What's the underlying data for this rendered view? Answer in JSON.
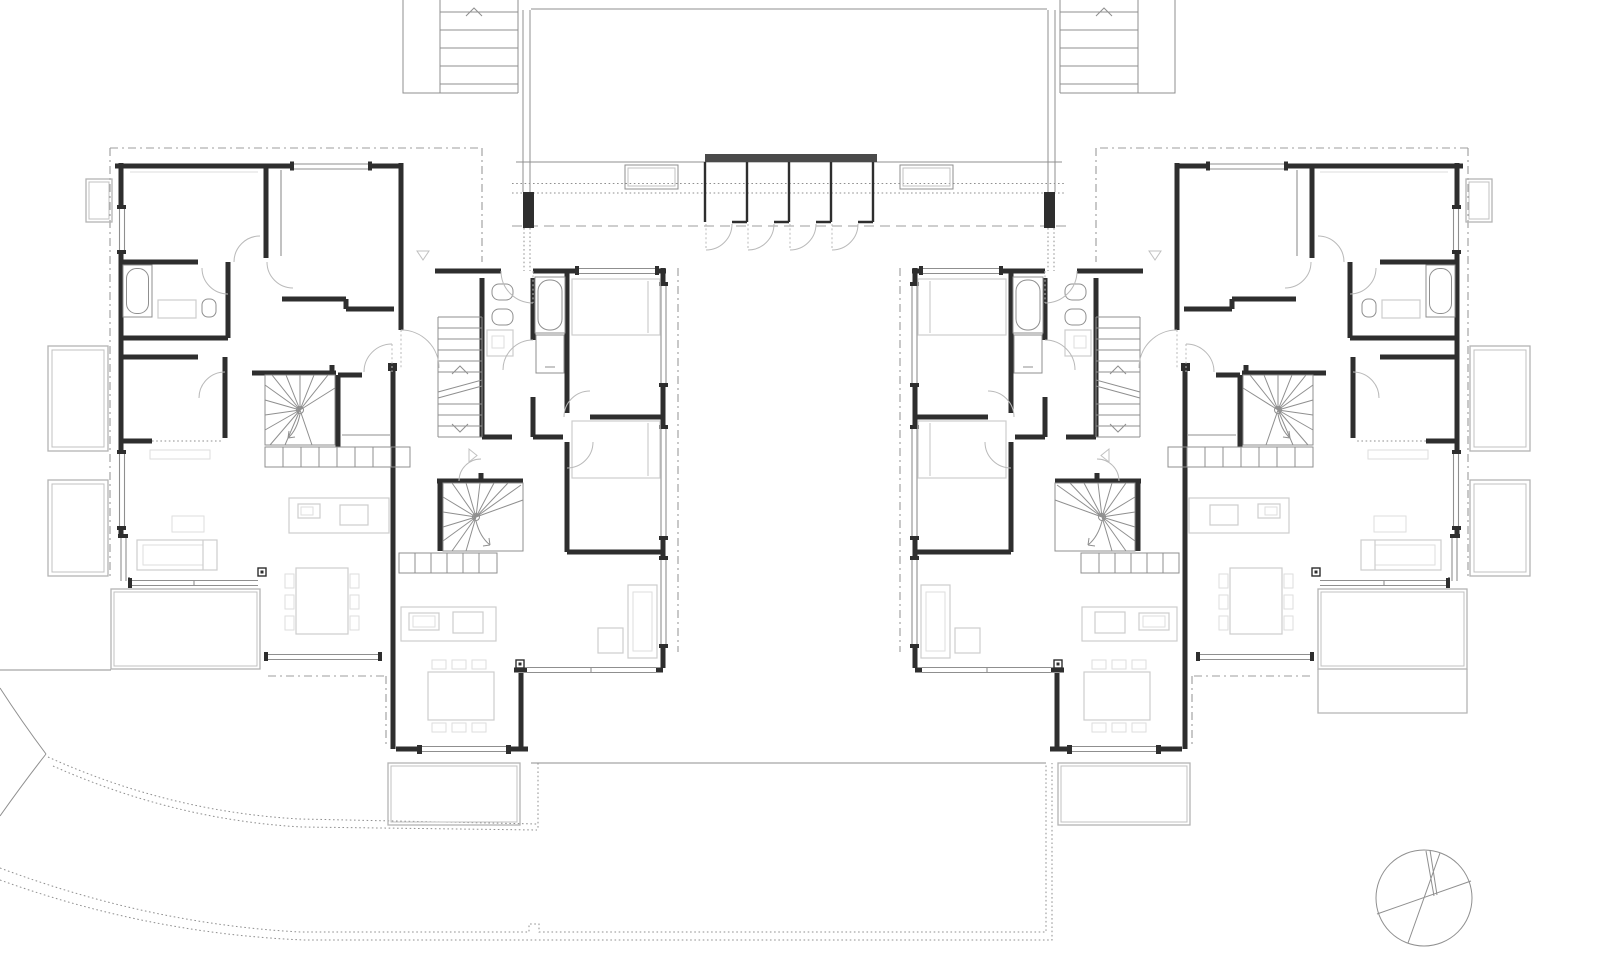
{
  "document": {
    "title": "Residential floor plan — two mirrored apartment blocks with central entry walkway",
    "type": "architectural-floor-plan",
    "visible_text": []
  },
  "palette": {
    "wall": "#2e2e2e",
    "mid": "#8f8f8f",
    "light": "#c0c0c0",
    "furn": "#cdcdcd",
    "furn2": "#dedede",
    "ter": "#b4b4b4",
    "arc": "#b9b9b9",
    "dash": "#9c9c9c",
    "storagebar": "#4a4a4a",
    "bg": "#ffffff"
  },
  "legend": {
    "blocks": [
      {
        "id": "block-left",
        "units": 2,
        "mirrored": false
      },
      {
        "id": "block-right",
        "units": 2,
        "mirrored": true
      }
    ],
    "shared_elements": [
      "entry-walkway",
      "storage-lockers-4",
      "skylight-left",
      "skylight-right",
      "exterior-stair-left",
      "exterior-stair-right"
    ],
    "per_unit_elements": [
      "bedrooms",
      "bathroom-with-tub",
      "wc",
      "winder-stair",
      "straight-stair",
      "kitchen-island",
      "dining-table-6-chairs",
      "sofa",
      "terrace"
    ],
    "site_elements": [
      "curved-road-edges",
      "dotted-plot-boundary",
      "tree-symbol"
    ],
    "storage_locker_count": 4,
    "tree_count": 1
  }
}
